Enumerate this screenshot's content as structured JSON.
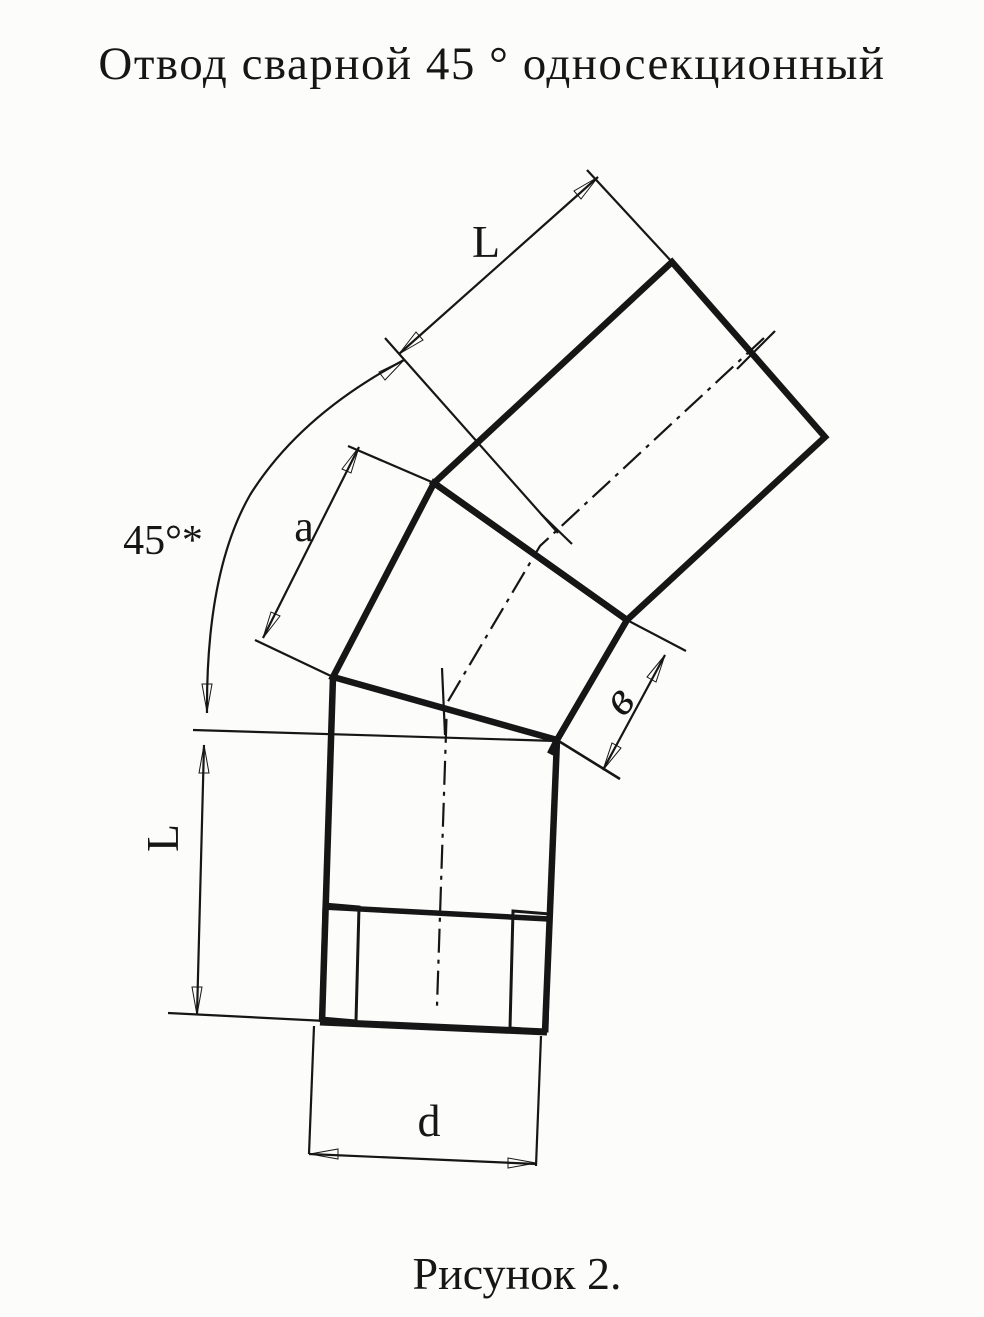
{
  "title": "Отвод сварной 45 ° односекционный",
  "caption": "Рисунок 2.",
  "labels": {
    "pipe_length_top": "L",
    "pipe_length_left": "L",
    "section_axis_length": "a",
    "section_side_width": "в",
    "bend_angle": "45°*",
    "diameter": "d"
  },
  "colors": {
    "ink": "#161616",
    "paper": "#fcfcfb"
  }
}
